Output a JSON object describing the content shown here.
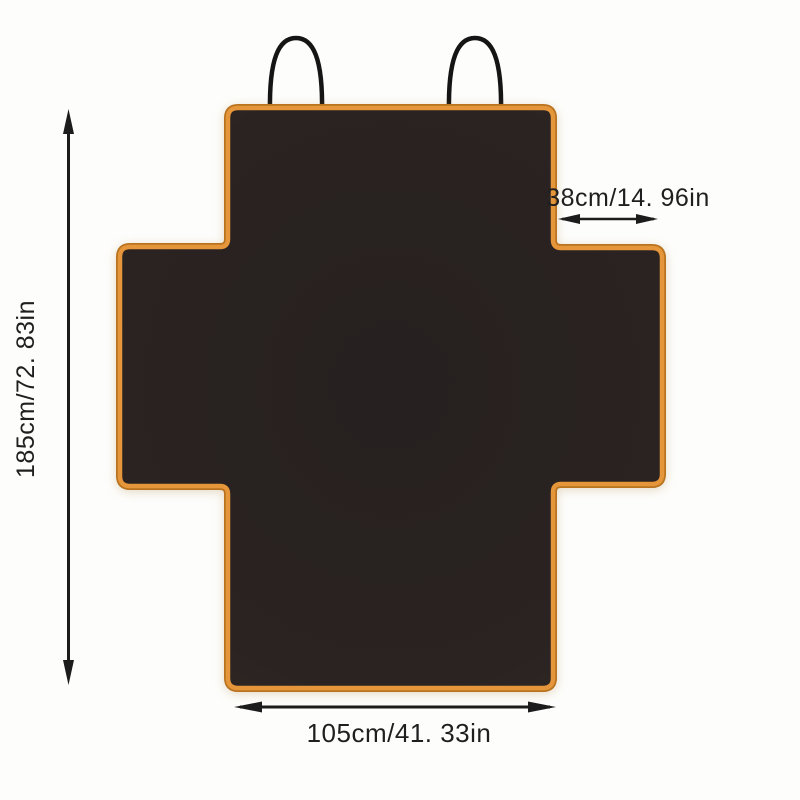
{
  "diagram": {
    "dimensions": {
      "height": {
        "cm": "185",
        "in": "72.83",
        "label": "185cm/72. 83in"
      },
      "top_flap_width": {
        "cm": "38",
        "in": "14.96",
        "label": "38cm/14. 96in"
      },
      "bottom_width": {
        "cm": "105",
        "in": "41.33",
        "label": "105cm/41. 33in"
      }
    },
    "colors": {
      "background": "#fdfdfb",
      "cover_fill_dark": "#2a2321",
      "border_orange": "#e5953a",
      "border_outer_edge": "#b9731f",
      "strap_black": "#151515",
      "annotation_black": "#1c1c1c"
    }
  }
}
